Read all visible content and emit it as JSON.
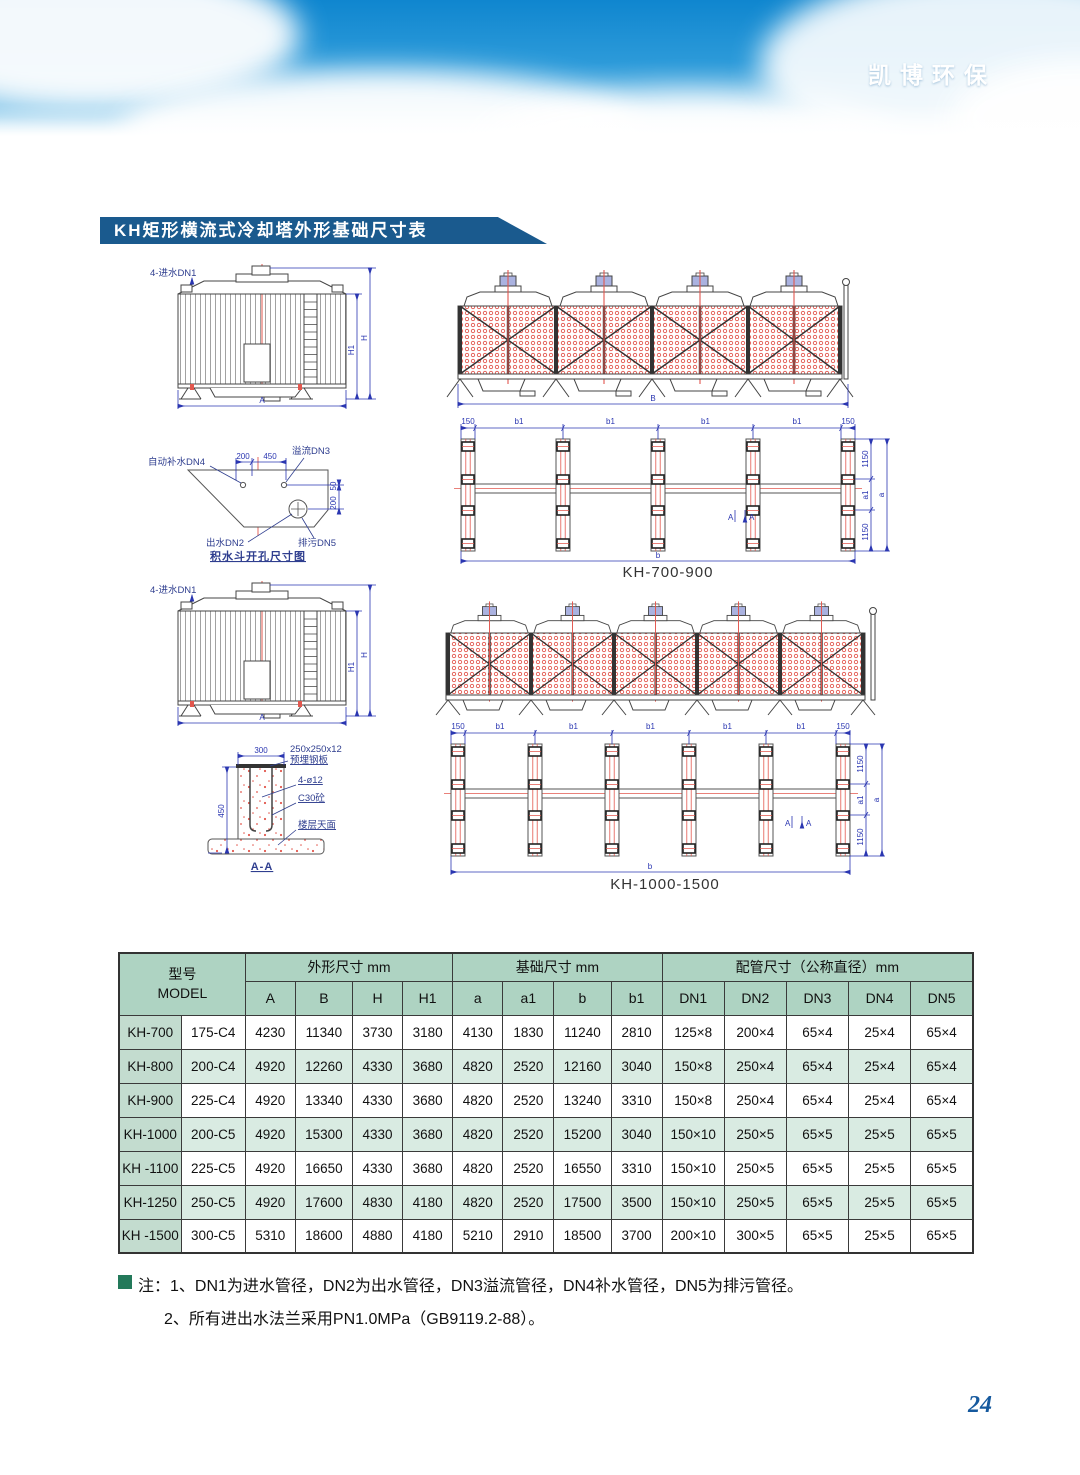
{
  "header": {
    "brand": "凯博环保"
  },
  "title_bar": {
    "text": "KH矩形横流式冷却塔外形基础尺寸表"
  },
  "drawings": {
    "tower": {
      "inlet": "4-进水DN1",
      "H": "H",
      "H1": "H1",
      "A": "A"
    },
    "hopper": {
      "makeup": "自动补水DN4",
      "overflow": "溢流DN3",
      "outlet": "出水DN2",
      "drain": "排污DN5",
      "d200": "200",
      "d450": "450",
      "d50": "50",
      "d200r": "200",
      "caption": "积水斗开孔尺寸图"
    },
    "section": {
      "d300": "300",
      "d450": "450",
      "plate1": "250x250x12",
      "plate2": "预埋钢板",
      "bolts": "4-ø12",
      "concrete": "C30砼",
      "floor": "楼层天面",
      "caption": "A-A"
    },
    "elevation": {
      "B": "B"
    },
    "plan": {
      "d150": "150",
      "b1": "b1",
      "d1150": "1150",
      "a1": "a1",
      "a": "a",
      "b": "b",
      "mark": "A"
    },
    "captions": {
      "plan1": "KH-700-900",
      "plan2": "KH-1000-1500"
    }
  },
  "table": {
    "header": {
      "model_cn": "型号",
      "model_en": "MODEL",
      "group1": "外形尺寸 mm",
      "group2": "基础尺寸 mm",
      "group3": "配管尺寸（公称直径）mm",
      "cols": [
        "A",
        "B",
        "H",
        "H1",
        "a",
        "a1",
        "b",
        "b1",
        "DN1",
        "DN2",
        "DN3",
        "DN4",
        "DN5"
      ]
    },
    "rows": [
      {
        "model": "KH-700",
        "type": "175-C4",
        "values": [
          "4230",
          "11340",
          "3730",
          "3180",
          "4130",
          "1830",
          "11240",
          "2810",
          "125×8",
          "200×4",
          "65×4",
          "25×4",
          "65×4"
        ]
      },
      {
        "model": "KH-800",
        "type": "200-C4",
        "values": [
          "4920",
          "12260",
          "4330",
          "3680",
          "4820",
          "2520",
          "12160",
          "3040",
          "150×8",
          "250×4",
          "65×4",
          "25×4",
          "65×4"
        ]
      },
      {
        "model": "KH-900",
        "type": "225-C4",
        "values": [
          "4920",
          "13340",
          "4330",
          "3680",
          "4820",
          "2520",
          "13240",
          "3310",
          "150×8",
          "250×4",
          "65×4",
          "25×4",
          "65×4"
        ]
      },
      {
        "model": "KH-1000",
        "type": "200-C5",
        "values": [
          "4920",
          "15300",
          "4330",
          "3680",
          "4820",
          "2520",
          "15200",
          "3040",
          "150×10",
          "250×5",
          "65×5",
          "25×5",
          "65×5"
        ]
      },
      {
        "model": "KH -1100",
        "type": "225-C5",
        "values": [
          "4920",
          "16650",
          "4330",
          "3680",
          "4820",
          "2520",
          "16550",
          "3310",
          "150×10",
          "250×5",
          "65×5",
          "25×5",
          "65×5"
        ]
      },
      {
        "model": "KH-1250",
        "type": "250-C5",
        "values": [
          "4920",
          "17600",
          "4830",
          "4180",
          "4820",
          "2520",
          "17500",
          "3500",
          "150×10",
          "250×5",
          "65×5",
          "25×5",
          "65×5"
        ]
      },
      {
        "model": "KH -1500",
        "type": "300-C5",
        "values": [
          "5310",
          "18600",
          "4880",
          "4180",
          "5210",
          "2910",
          "18500",
          "3700",
          "200×10",
          "300×5",
          "65×5",
          "25×5",
          "65×5"
        ]
      }
    ]
  },
  "notes": {
    "label": "注：",
    "line1": "1、DN1为进水管径，DN2为出水管径，DN3溢流管径，DN4补水管径，DN5为排污管径。",
    "line2": "2、所有进出水法兰采用PN1.0MPa（GB9119.2-88）。"
  },
  "page_number": "24",
  "colors": {
    "banner_blue": "#1488cf",
    "title_bar": "#1a5a8e",
    "table_header_green": "#aed3c2",
    "table_stripe": "#d9ebe2",
    "model_col": "#c3dccf",
    "drawing_red": "#e2574e",
    "dim_blue": "#2a36b1",
    "note_bullet": "#23795a",
    "page_number_blue": "#15599e"
  }
}
